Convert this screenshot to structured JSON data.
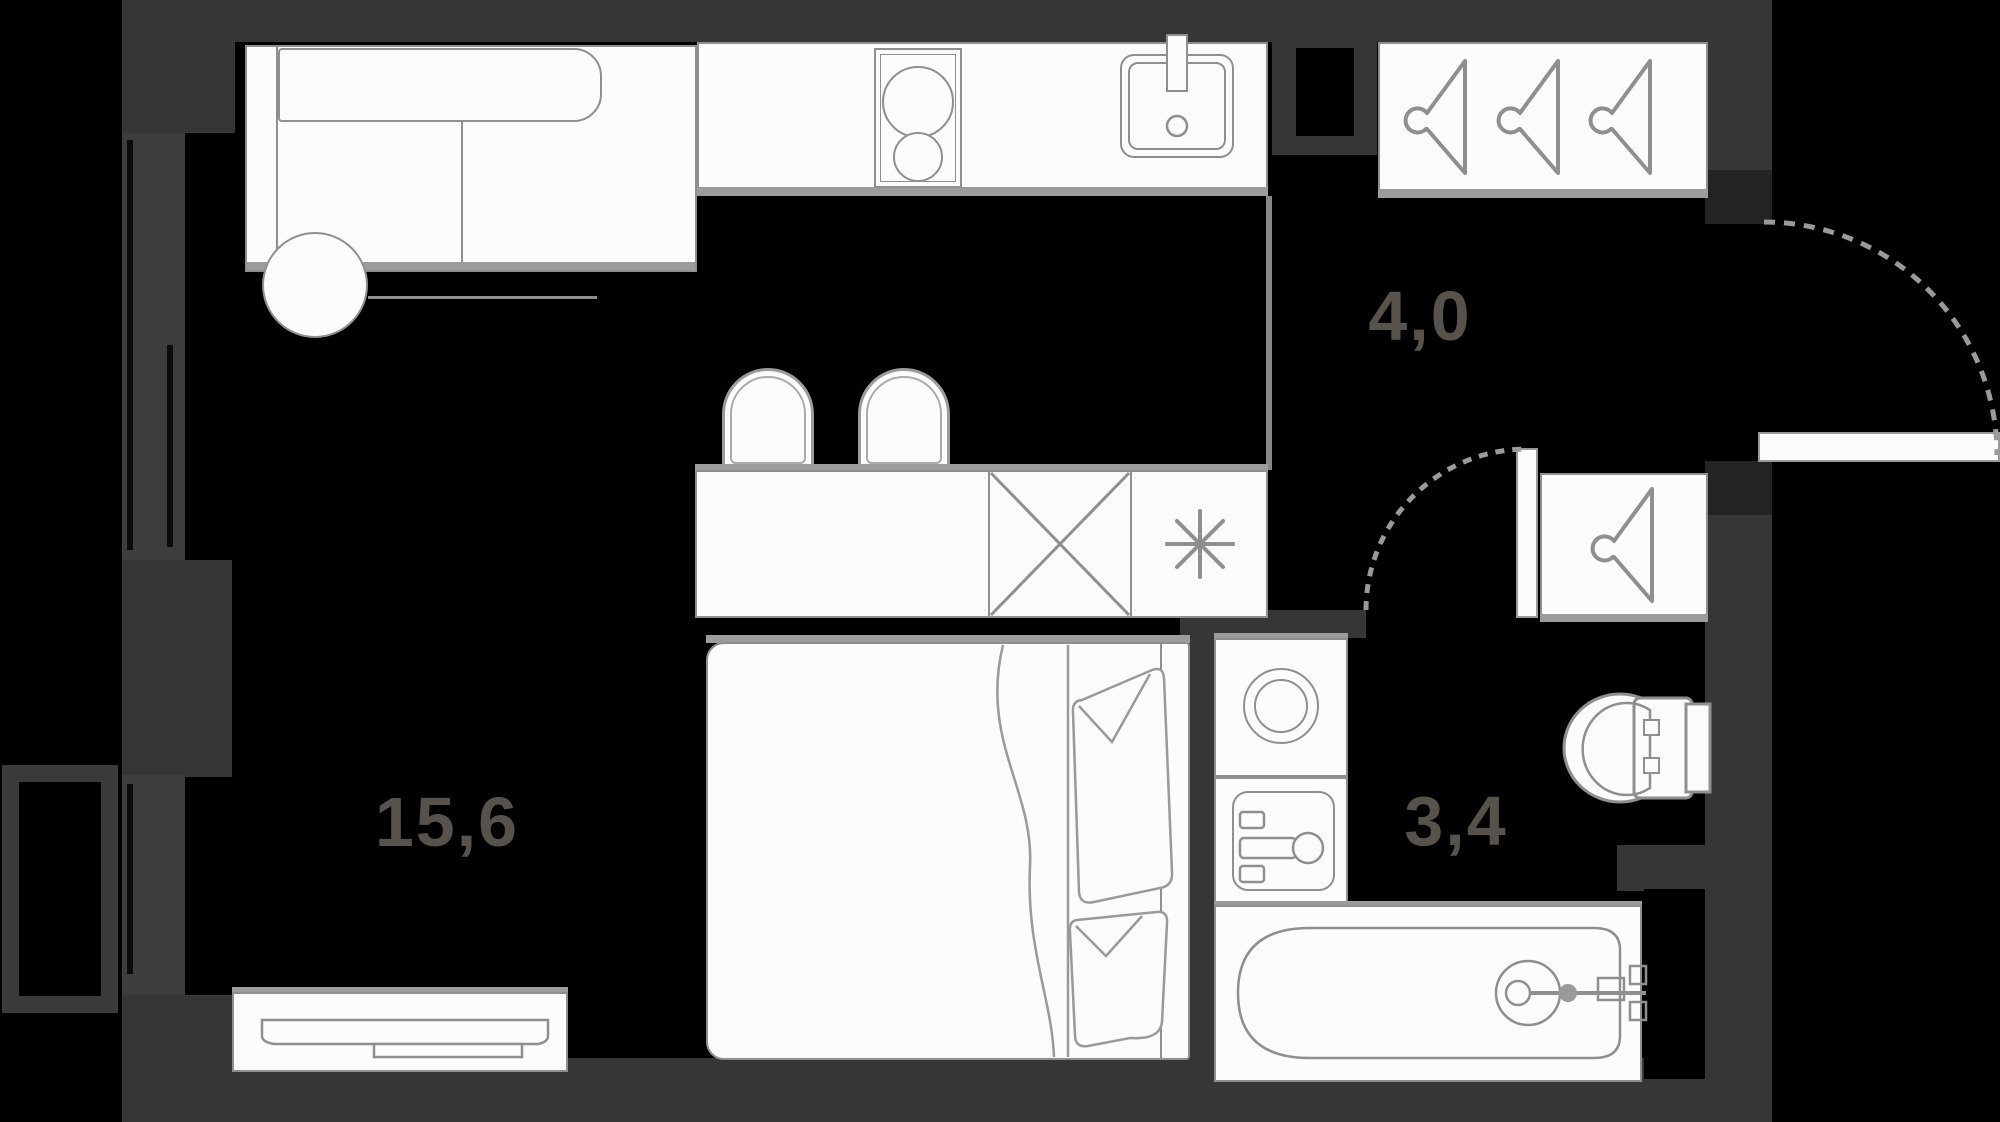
{
  "plan": {
    "type": "apartment-floor-plan",
    "rooms": [
      {
        "id": "living-kitchen",
        "area_label": "15,6"
      },
      {
        "id": "hallway",
        "area_label": "4,0"
      },
      {
        "id": "bathroom",
        "area_label": "3,4"
      }
    ],
    "total_area_labels": [
      "15,6",
      "4,0",
      "3,4"
    ],
    "furniture": [
      "sofa",
      "round-table",
      "kitchen-counter",
      "stove",
      "kitchen-sink",
      "bar-counter",
      "chair",
      "chair",
      "washing-machine",
      "fridge",
      "wardrobe-3-hangers",
      "closet-1-hanger",
      "double-bed",
      "tv-console",
      "washer-top",
      "washbasin",
      "toilet",
      "bathtub",
      "entrance-door",
      "bathroom-door",
      "window",
      "balcony-basket",
      "vent-shaft"
    ],
    "colors": {
      "floor": "#000000",
      "wall": "#363636",
      "window_wall": "#3d3d3d",
      "furniture_fill": "#fcfcfc",
      "furniture_outline": "#8f8f8f",
      "shadow": "#9c9c9c",
      "label_text": "#57524b"
    }
  }
}
